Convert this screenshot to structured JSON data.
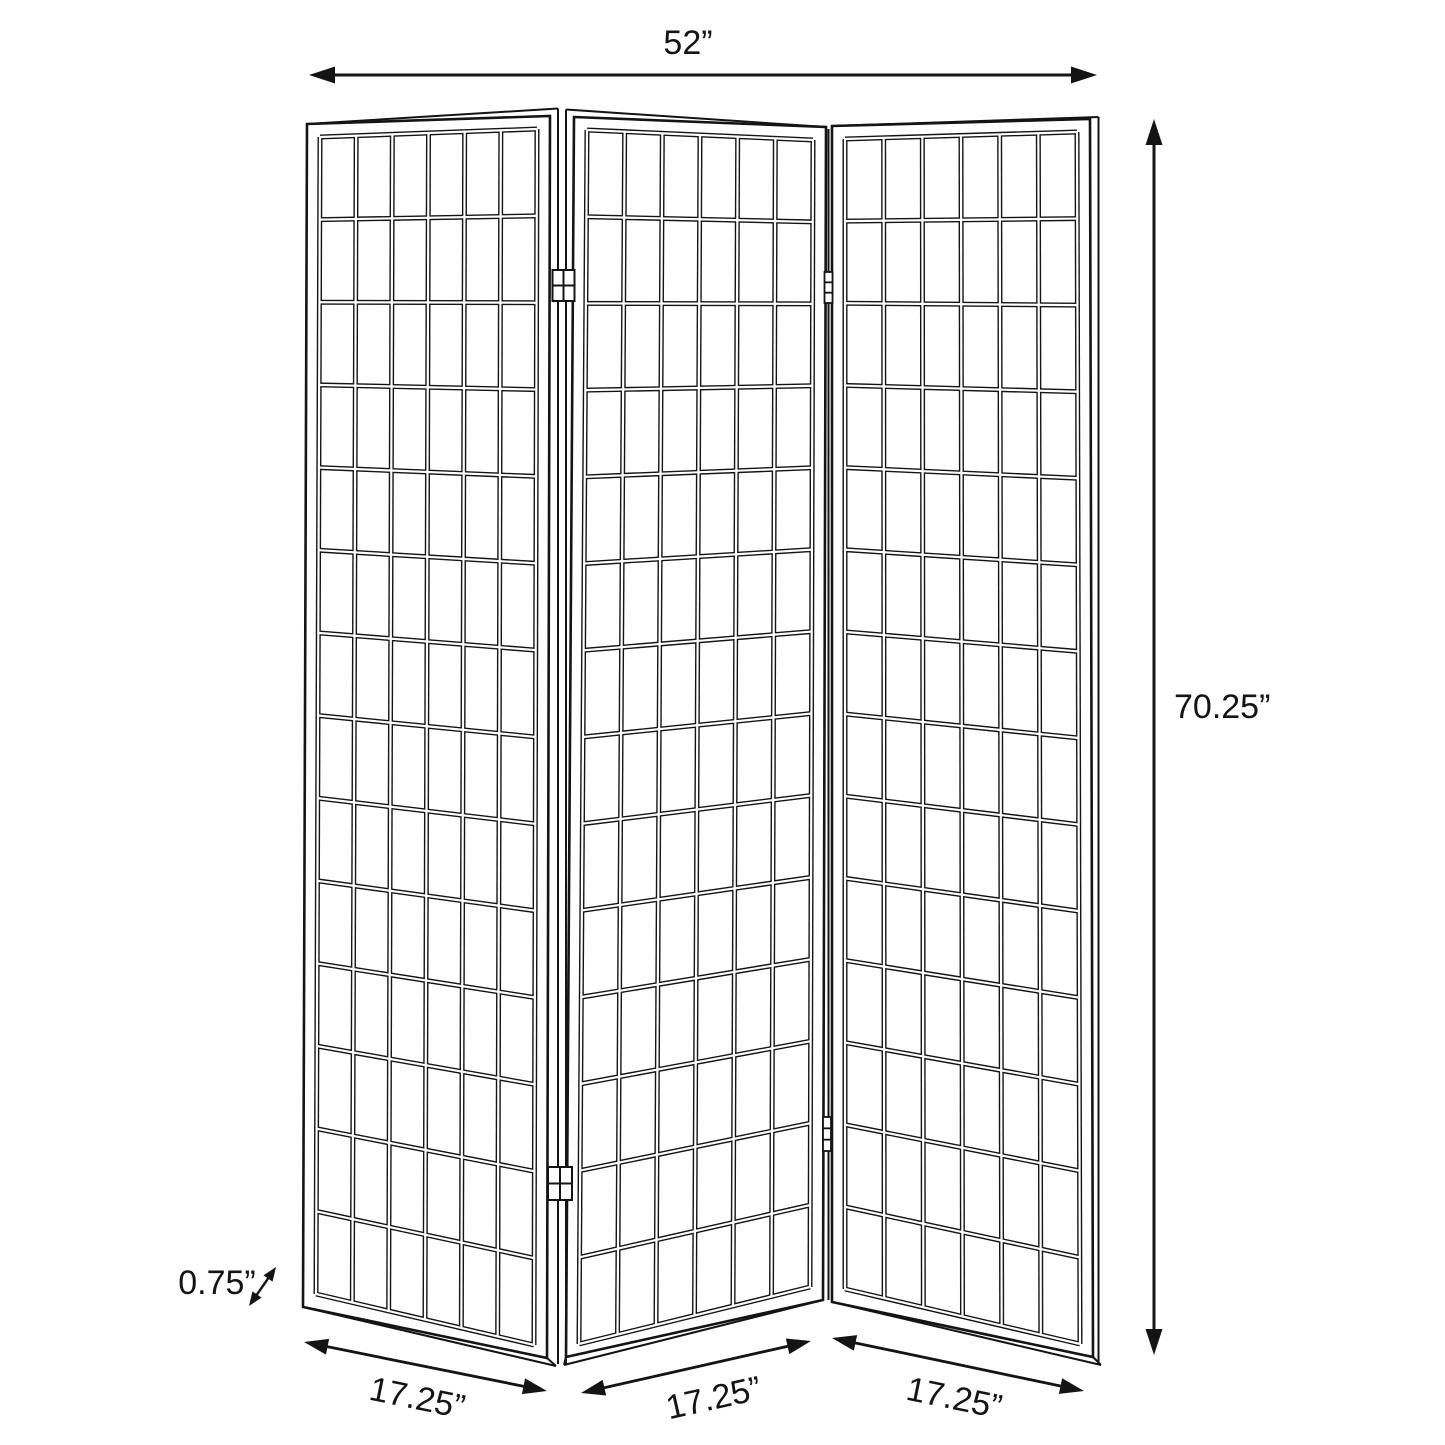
{
  "canvas": {
    "background": "#ffffff",
    "line_color": "#141414",
    "width_px": 1445,
    "height_px": 1445
  },
  "diagram": {
    "type": "product-dimension-diagram",
    "subject": "three-panel folding screen room divider with lattice grid panels",
    "panel_count": 3,
    "lattice": {
      "columns_per_panel": 6,
      "rows_per_panel": 14
    },
    "hinge_pairs": 2,
    "dimensions": {
      "overall_width": {
        "label": "52”"
      },
      "overall_height": {
        "label": "70.25”"
      },
      "frame_thickness": {
        "label": "0.75”"
      },
      "panel_widths": [
        "17.25”",
        "17.25”",
        "17.25”"
      ]
    }
  }
}
